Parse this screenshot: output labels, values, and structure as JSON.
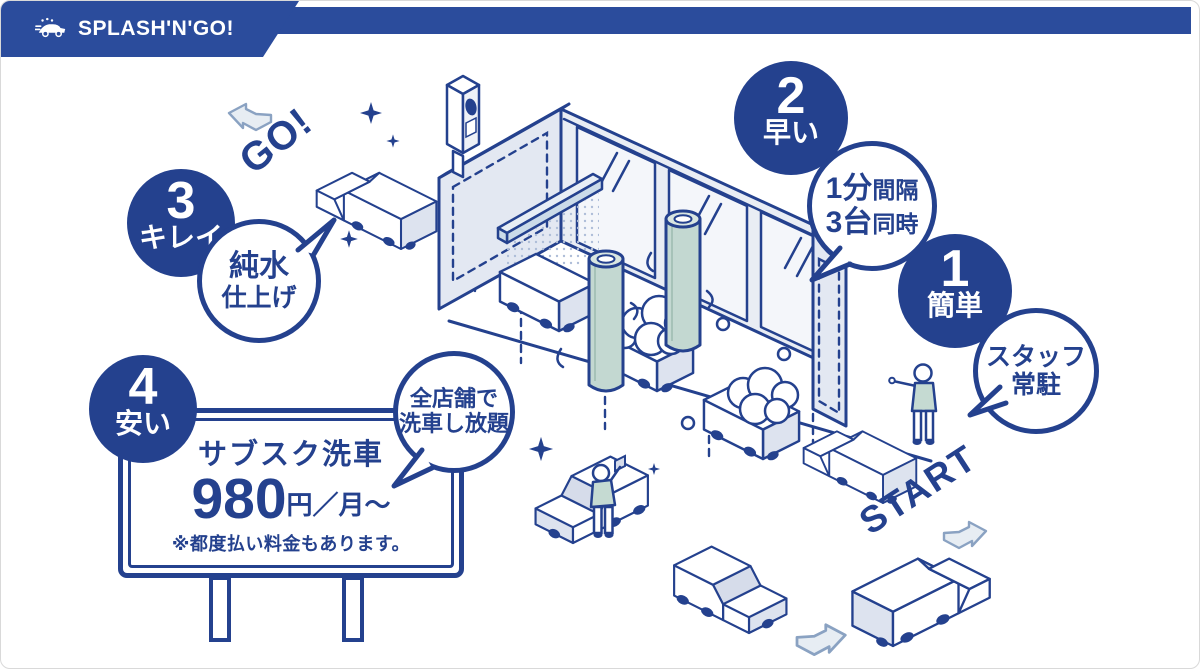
{
  "header": {
    "brand": "SPLASH'N'GO!"
  },
  "flow_labels": {
    "go": "GO!",
    "start": "START"
  },
  "features": [
    {
      "number": "1",
      "title": "簡単",
      "bubble_line1": "スタッフ",
      "bubble_line2": "常駐"
    },
    {
      "number": "2",
      "title": "早い",
      "bubble_line1_big": "1分",
      "bubble_line1_small": "間隔",
      "bubble_line2_big": "3台",
      "bubble_line2_small": "同時"
    },
    {
      "number": "3",
      "title": "キレイ",
      "bubble_line1": "純水",
      "bubble_line2": "仕上げ"
    },
    {
      "number": "4",
      "title": "安い"
    }
  ],
  "signboard": {
    "title": "サブスク洗車",
    "price": "980",
    "price_unit": "円／月〜",
    "note": "※都度払い料金もあります。",
    "bubble_line1": "全店舗で",
    "bubble_line2": "洗車し放題"
  },
  "colors": {
    "navy": "#24418e",
    "banner_blue": "#2b4c9c",
    "panel_gray": "#e3e8f2",
    "glass_white": "#f4f6fa",
    "brush_teal": "#c3d8d1",
    "spray_blue": "#cbdbe9",
    "arrow_gray": "#e7edf3"
  }
}
